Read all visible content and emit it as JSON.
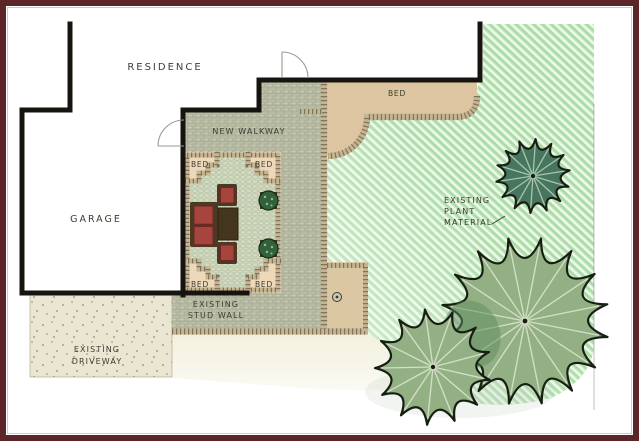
{
  "document_title": "Residential Landscape Plan",
  "labels": {
    "residence": "RESIDENCE",
    "garage": "GARAGE",
    "new_walkway": "NEW WALKWAY",
    "bed": "BED",
    "existing": "EXISTING",
    "stud_wall": "STUD WALL",
    "driveway": "DRIVEWAY",
    "plant": "PLANT",
    "material": "MATERIAL"
  },
  "colors": {
    "border": "#5c2628",
    "frameInner": "#d9c6c6",
    "wall": "#17140f",
    "text": "#3e3c32",
    "walkway": "#b8bca5",
    "walkwayJoint": "#9aa086",
    "walkwayFleck": "#e9e6cb",
    "courtyard": "#d4dcc3",
    "courtyardJoint": "#b5c1a2",
    "bedTop": "#dcc5a0",
    "cornerBed": "#eed8ba",
    "pad": "#dcc7a3",
    "brick": "#c6b591",
    "brickRung": "#6d6350",
    "grass": "#bce4b6",
    "grassLight": "#f0faee",
    "grassDark": "#8ecd8b",
    "cream": "#f2f0dd",
    "drive": "#eae6d1",
    "driveDot": "#6f6f55",
    "treeDark": "#47755e",
    "treeDarkRay": "#b9d6c1",
    "treeLight": "#92b083",
    "treeLightRay": "#e7efd9",
    "treeLine": "#2d482b",
    "treeOutline": "#161f12",
    "treeOverlap": "#5d8a5d",
    "shrub": "#33613a",
    "shrubDot": "#8fbf8d",
    "planter": "#443424",
    "sofaRed": "#a6453d",
    "cushionLine": "#6f2721",
    "furnBrown": "#4a3a23",
    "tableBrown": "#44351e",
    "door": "#9a9a92",
    "propLine": "#6e6e66",
    "padCircle": "#3c3b30"
  }
}
